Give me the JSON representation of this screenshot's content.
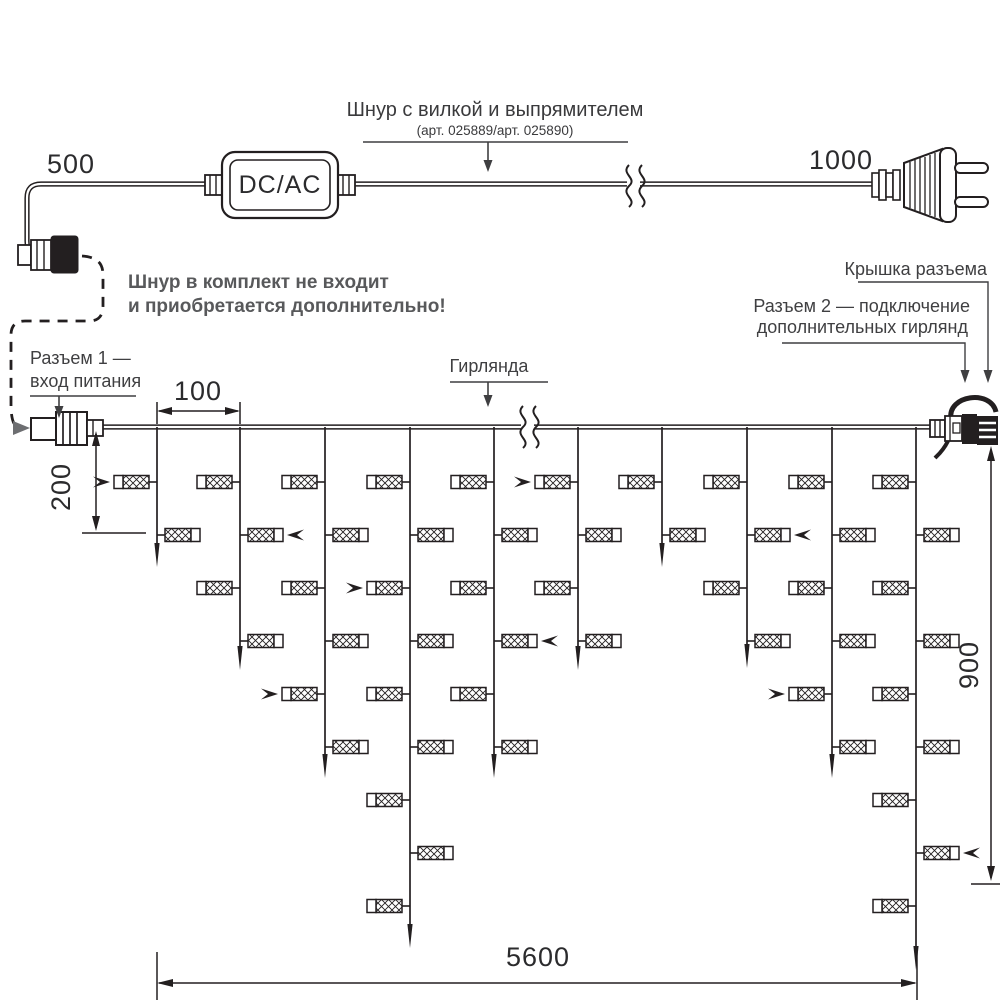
{
  "diagram": {
    "colors": {
      "ink": "#231f20",
      "label": "#3f3f41",
      "note_gray": "#58595b"
    },
    "power_cord": {
      "title": "Шнур с вилкой и выпрямителем",
      "subtitle": "(арт. 025889/арт. 025890)",
      "left_length": "500",
      "right_length": "1000",
      "converter_label": "DC/AC"
    },
    "note": {
      "line1": "Шнур в комплект не входит",
      "line2": "и приобретается дополнительно!"
    },
    "callouts": {
      "connector1_line1": "Разъем 1 —",
      "connector1_line2": "вход питания",
      "garland": "Гирлянда",
      "cap": "Крышка разъема",
      "connector2_line1": "Разъем 2 — подключение",
      "connector2_line2": "дополнительных гирлянд"
    },
    "dimensions": {
      "drop_spacing": "100",
      "first_drop_height": "200",
      "total_height": "900",
      "total_length": "5600"
    },
    "garland": {
      "main_y": 427,
      "lamp_row_start": 482,
      "lamp_row_step": 53,
      "drops": [
        {
          "x": 157,
          "lamps": 2,
          "tip": 567,
          "arrow": {
            "lamp": 0
          }
        },
        {
          "x": 240,
          "lamps": 4,
          "tip": 670,
          "arrow": {
            "lamp": 1
          }
        },
        {
          "x": 325,
          "lamps": 6,
          "tip": 778,
          "arrow": {
            "lamp": 4
          }
        },
        {
          "x": 410,
          "lamps": 9,
          "tip": 948,
          "arrow": {
            "lamp": 2
          }
        },
        {
          "x": 494,
          "lamps": 6,
          "tip": 778,
          "arrow": {
            "lamp": 3
          }
        },
        {
          "x": 578,
          "lamps": 4,
          "tip": 670,
          "arrow": {
            "lamp": 0
          }
        },
        {
          "x": 662,
          "lamps": 2,
          "tip": 567,
          "arrow": null
        },
        {
          "x": 747,
          "lamps": 4,
          "tip": 668,
          "arrow": {
            "lamp": 1
          }
        },
        {
          "x": 832,
          "lamps": 6,
          "tip": 778,
          "arrow": {
            "lamp": 4
          }
        },
        {
          "x": 916,
          "lamps": 9,
          "tip": 970,
          "arrow": {
            "lamp": 7
          }
        }
      ]
    }
  }
}
